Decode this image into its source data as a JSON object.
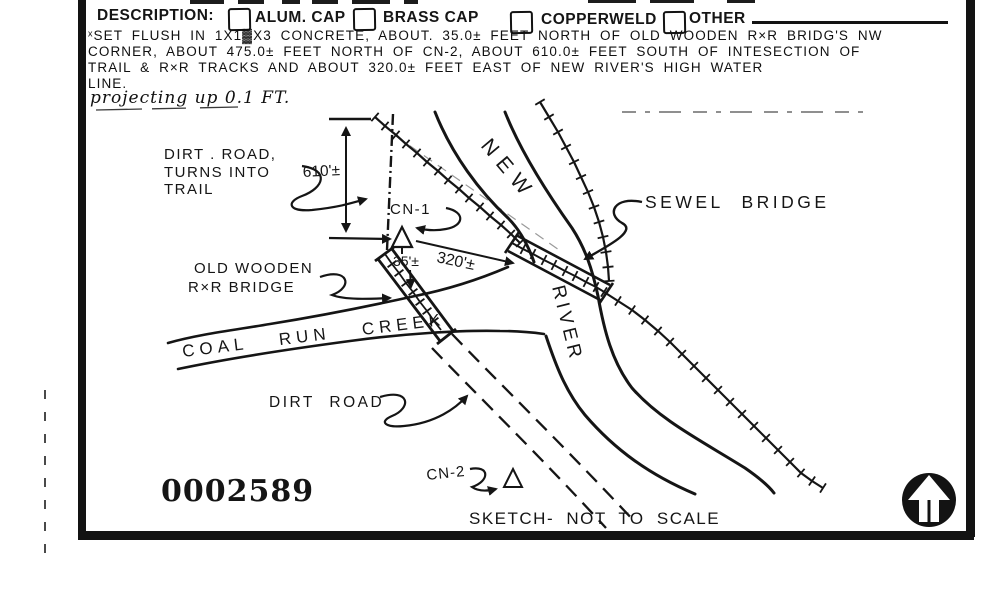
{
  "header": {
    "label": "DESCRIPTION:",
    "options": [
      {
        "label": "ALUM. CAP",
        "checked": false
      },
      {
        "label": "BRASS CAP",
        "checked": false
      },
      {
        "label": "COPPERWELD",
        "checked": false
      },
      {
        "label": "OTHER",
        "checked": false
      }
    ]
  },
  "description": {
    "lines": [
      "ˣSET FLUSH IN 1X1▓X3 CONCRETE, ABOUT. 35.0± FEET NORTH OF OLD WOODEN R×R BRIDG'S NW",
      "CORNER, ABOUT 475.0± FEET NORTH OF CN-2, ABOUT 610.0± FEET SOUTH OF INTESECTION OF",
      "TRAIL & R×R TRACKS AND ABOUT 320.0± FEET EAST OF NEW RIVER'S HIGH WATER",
      "LINE."
    ],
    "projection_note": "projecting up 0.1 FT."
  },
  "sketch": {
    "dirt_road_line1": "DIRT . ROAD,",
    "dirt_road_line2": "TURNS INTO",
    "dirt_road_line3": "TRAIL",
    "dim_610": "610'±",
    "cn1": "CN-1",
    "dim_320": "320'±",
    "dim_35": "35'±",
    "river_word1": "NEW",
    "river_word2": "RIVER",
    "sewel_bridge": "SEWEL BRIDGE",
    "old_bridge_line1": "OLD WOODEN",
    "old_bridge_line2": "R×R BRIDGE",
    "creek": "COAL RUN CREEK",
    "dirt_road2": "DIRT ROAD",
    "cn2": "CN-2",
    "stamp": "0002589",
    "footer": "SKETCH- NOT TO SCALE"
  }
}
